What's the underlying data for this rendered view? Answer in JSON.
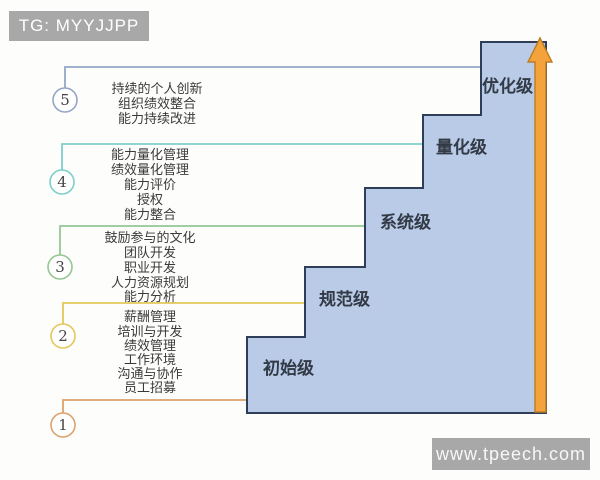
{
  "header": {
    "text": "TG: MYYJJPP"
  },
  "watermark": {
    "text": "www.tpeech.com"
  },
  "colors": {
    "step_fill": "#b9cbe6",
    "step_border": "#2e3d58",
    "arrow_fill": "#f4a33c",
    "arrow_border": "#bd7d20",
    "header_bg": "#a8a8a8",
    "level1": "#dca26c",
    "level2": "#e4c75a",
    "level3": "#93c893",
    "level4": "#7ccfca",
    "level5": "#93a6c8"
  },
  "steps": [
    {
      "label": "初始级"
    },
    {
      "label": "规范级"
    },
    {
      "label": "系统级"
    },
    {
      "label": "量化级"
    },
    {
      "label": "优化级"
    }
  ],
  "levels": [
    {
      "number": "1",
      "color": "#dca26c",
      "items": []
    },
    {
      "number": "2",
      "color": "#e4c75a",
      "items": [
        "薪酬管理",
        "培训与开发",
        "绩效管理",
        "工作环境",
        "沟通与协作",
        "员工招募"
      ]
    },
    {
      "number": "3",
      "color": "#93c893",
      "items": [
        "鼓励参与的文化",
        "团队开发",
        "职业开发",
        "人力资源规划",
        "能力分析"
      ]
    },
    {
      "number": "4",
      "color": "#7ccfca",
      "items": [
        "能力量化管理",
        "绩效量化管理",
        "能力评价",
        "授权",
        "能力整合"
      ]
    },
    {
      "number": "5",
      "color": "#93a6c8",
      "items": [
        "持续的个人创新",
        "组织绩效整合",
        "能力持续改进"
      ]
    }
  ]
}
